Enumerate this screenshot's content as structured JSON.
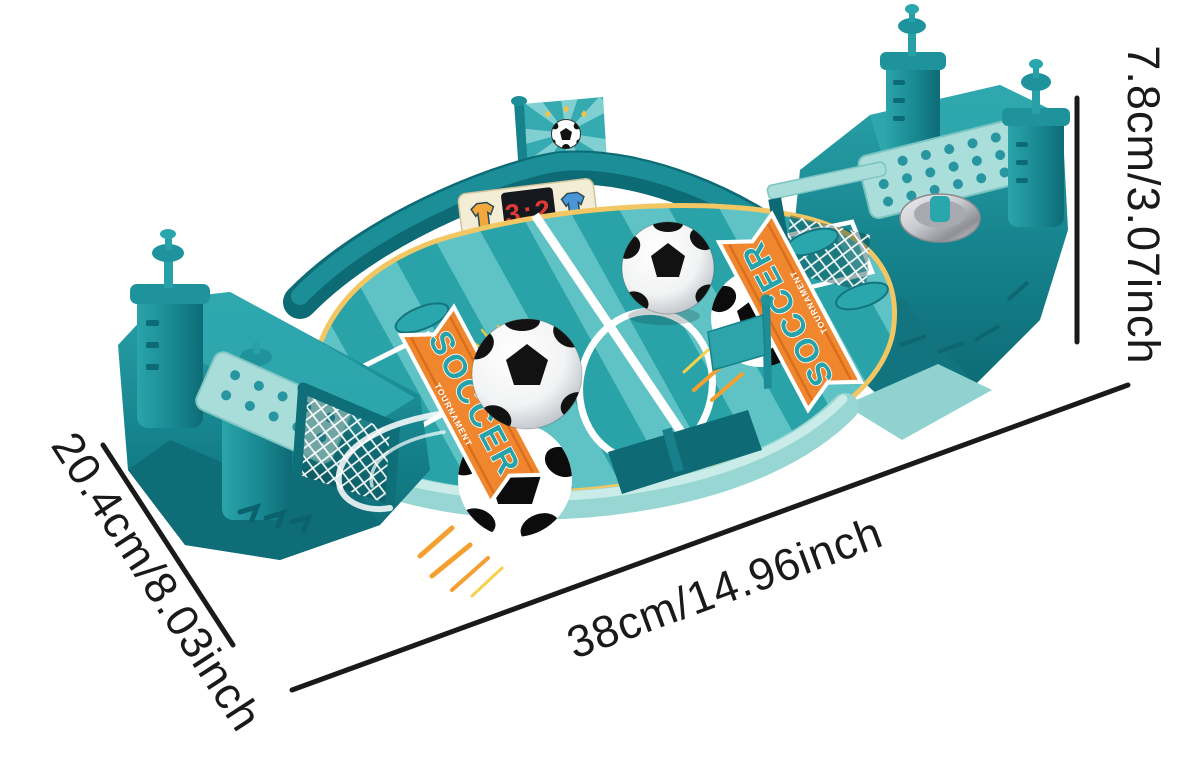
{
  "scene": {
    "description": "tabletop soccer game product photo with dimension annotations",
    "background_color": "#ffffff"
  },
  "annotations": {
    "length_label": "38cm/14.96inch",
    "depth_label": "20.4cm/8.03inch",
    "height_label": "7.8cm/3.07inch",
    "line_color": "#1a1a1a"
  },
  "toy": {
    "scoreboard": {
      "score": "3:2",
      "left_team_icon": "yellow-jersey",
      "right_team_icon": "blue-jersey"
    },
    "flag_emblem_icon": "soccer-ball",
    "banner_left": {
      "title": "SOCCER",
      "subtitle": "TOURNAMENT"
    },
    "banner_right": {
      "title": "SOCCER",
      "subtitle": "TOURNAMENT"
    },
    "colors": {
      "body_dark": "#117a84",
      "body_mid": "#2aa7ad",
      "body_light": "#9fd9d5",
      "field_stripe_dark": "#2aa3a8",
      "field_stripe_light": "#5fc2c5",
      "boundary_yellow": "#f2c763",
      "banner_orange": "#f0862e",
      "score_red": "#e03a35"
    }
  }
}
